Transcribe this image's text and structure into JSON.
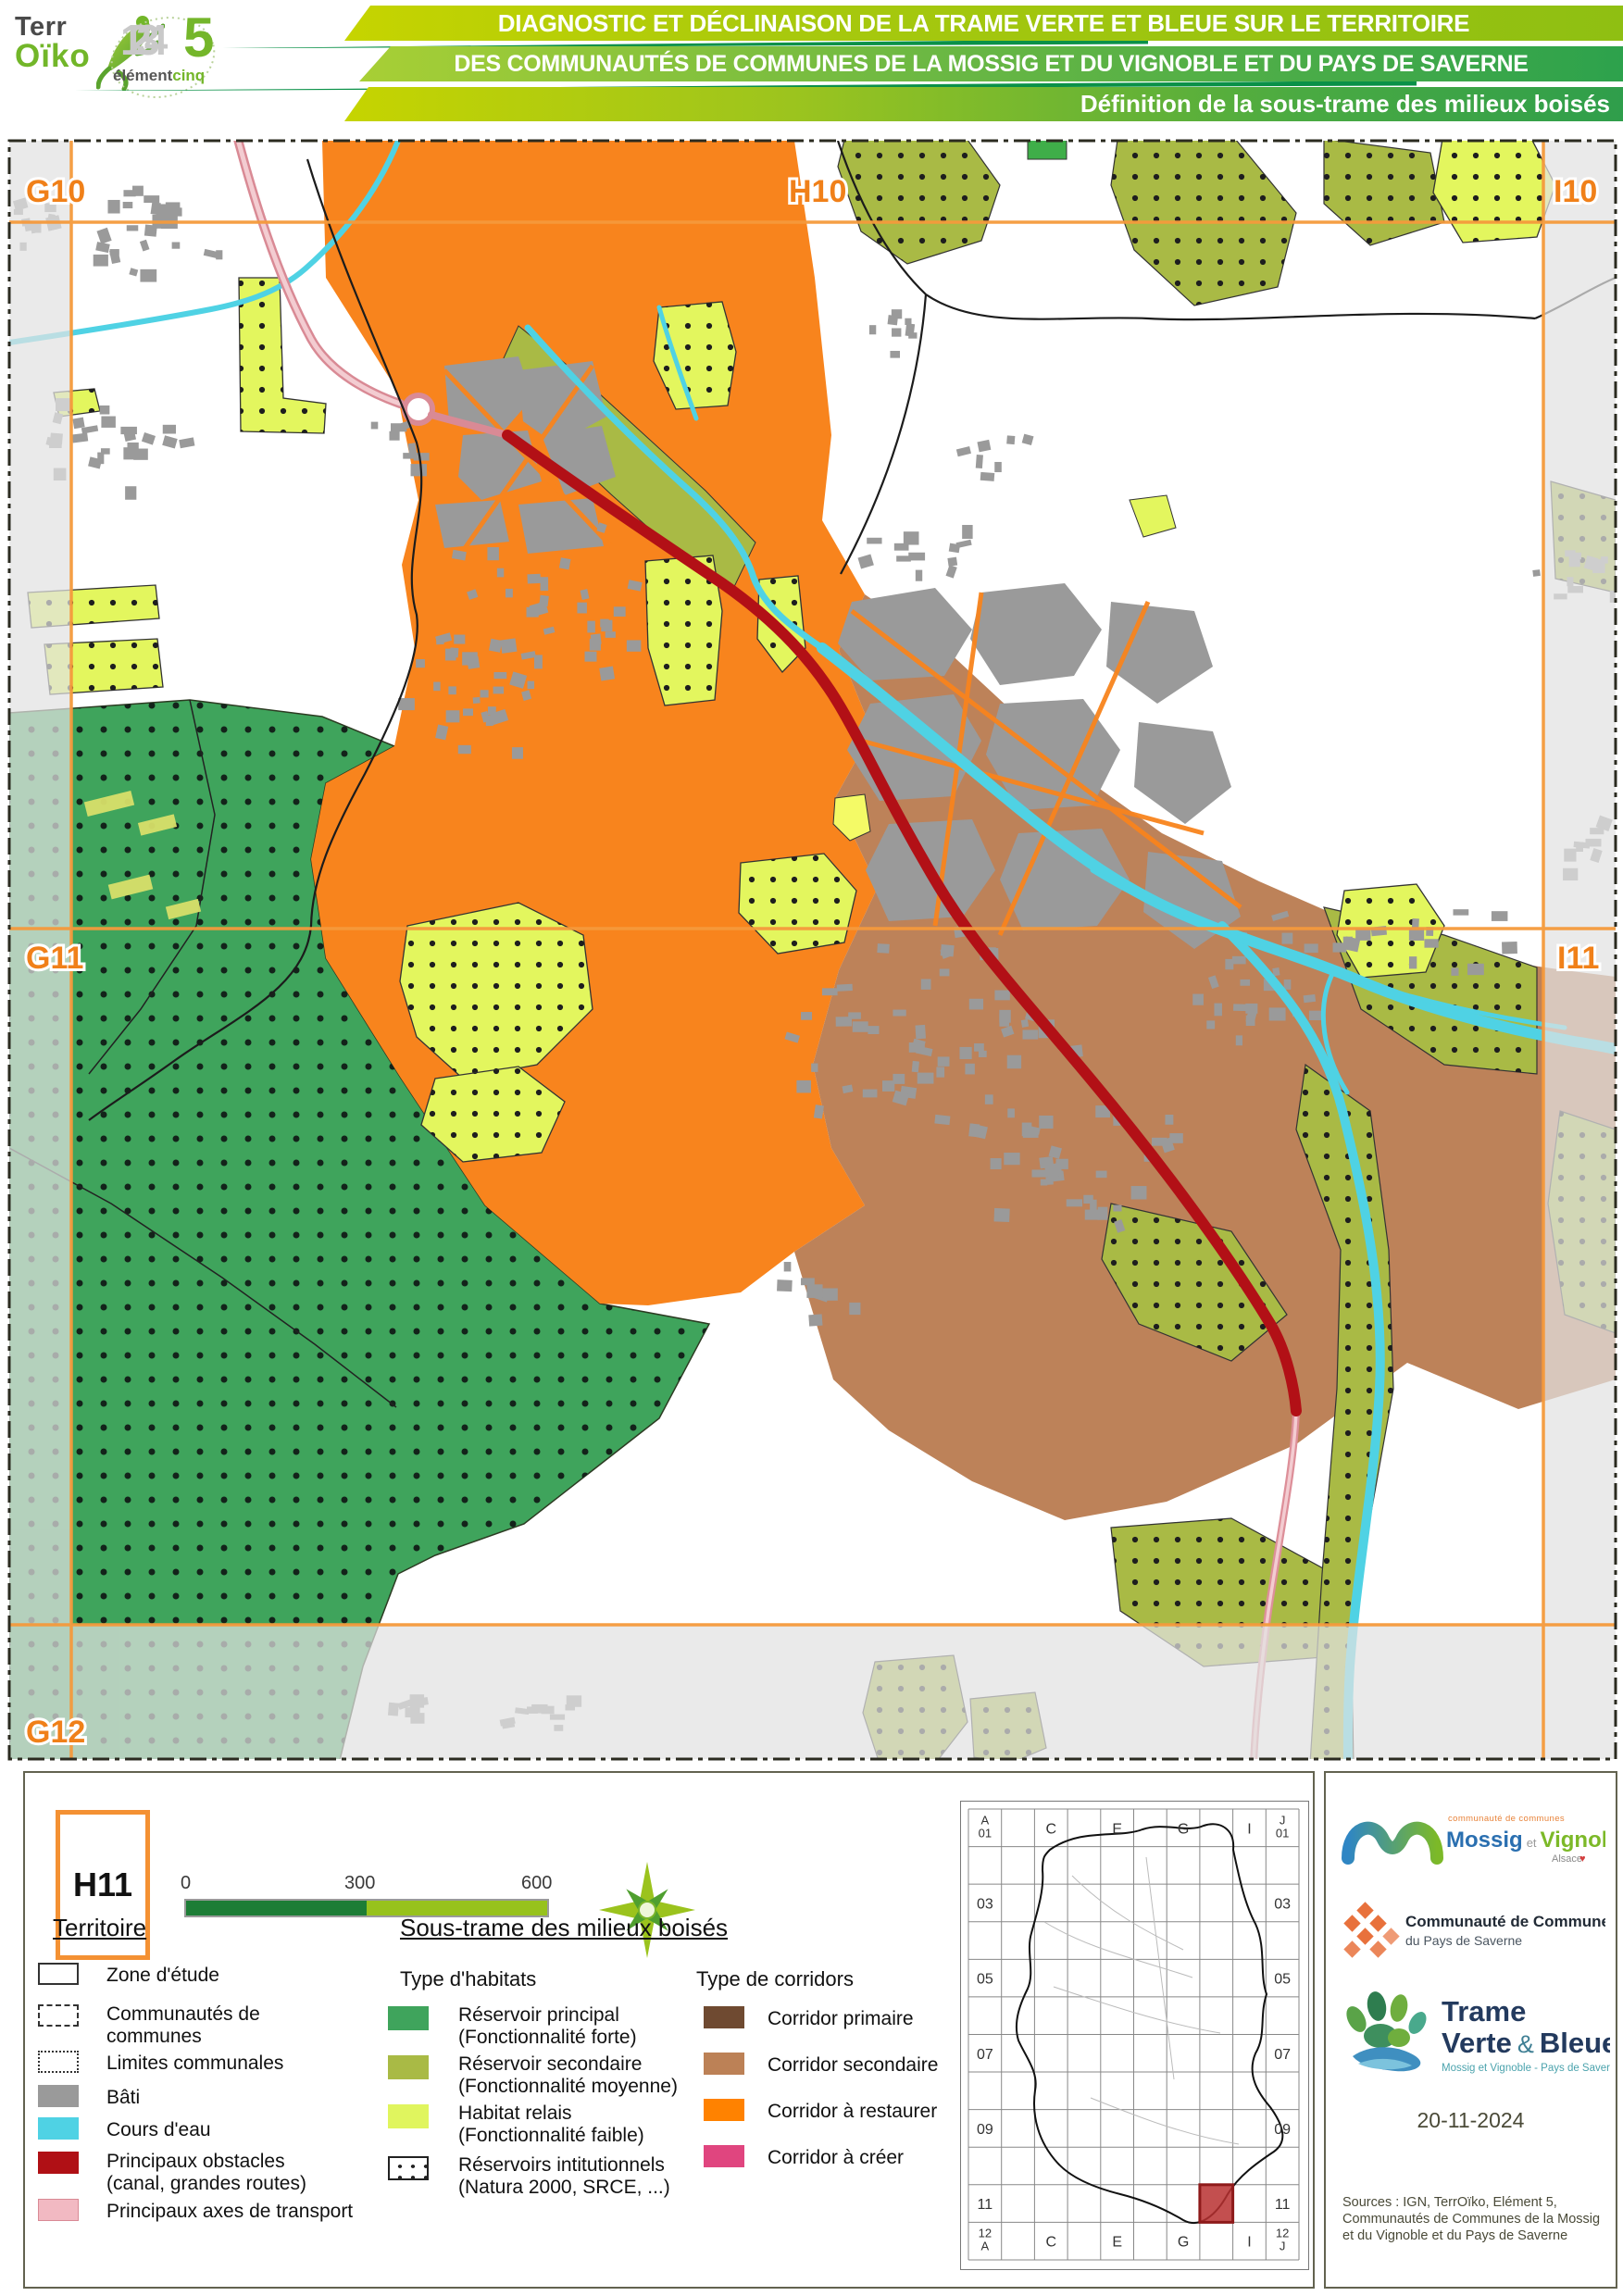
{
  "header": {
    "logo_terroiko": {
      "part1": "Terr",
      "part2": "Oïko"
    },
    "logo_element5": {
      "digits": "1234",
      "five": "5",
      "word1": "élément",
      "word2": "cinq"
    },
    "banner1": "DIAGNOSTIC ET DÉCLINAISON DE LA TRAME VERTE ET BLEUE SUR LE TERRITOIRE",
    "banner2": "DES COMMUNAUTÉS DE COMMUNES DE LA MOSSIG ET DU VIGNOBLE ET DU PAYS DE SAVERNE",
    "banner3": "Définition de la sous-trame des milieux boisés"
  },
  "map": {
    "grid_labels": [
      {
        "text": "G10"
      },
      {
        "text": "H10"
      },
      {
        "text": "I10"
      },
      {
        "text": "G11"
      },
      {
        "text": "I11"
      },
      {
        "text": "G12"
      }
    ]
  },
  "legend": {
    "tile": "H11",
    "scale": {
      "t0": "0",
      "t1": "300",
      "t2": "600 m"
    },
    "territoire": {
      "heading": "Territoire",
      "items": [
        {
          "label": "Zone d'étude"
        },
        {
          "label": "Communautés de communes"
        },
        {
          "label": "Limites communales"
        },
        {
          "label": "Bâti"
        },
        {
          "label": "Cours d'eau"
        },
        {
          "label": "Principaux obstacles (canal, grandes routes)"
        },
        {
          "label": "Principaux axes de transport"
        }
      ]
    },
    "soustrame": {
      "heading": "Sous-trame des milieux boisés",
      "habitats_title": "Type d'habitats",
      "habitats": [
        {
          "label": "Réservoir principal",
          "sub": "(Fonctionnalité forte)"
        },
        {
          "label": "Réservoir secondaire",
          "sub": "(Fonctionnalité moyenne)"
        },
        {
          "label": "Habitat relais",
          "sub": "(Fonctionnalité faible)"
        },
        {
          "label": "Réservoirs intitutionnels",
          "sub": "(Natura 2000, SRCE, ...)"
        }
      ],
      "corridors_title": "Type de corridors",
      "corridors": [
        {
          "label": "Corridor primaire"
        },
        {
          "label": "Corridor secondaire"
        },
        {
          "label": "Corridor à restaurer"
        },
        {
          "label": "Corridor à créer"
        }
      ]
    }
  },
  "minimap": {
    "labels": [
      {
        "c": 0,
        "r": 0,
        "t": "A|01"
      },
      {
        "c": 2,
        "r": 0,
        "t": "C"
      },
      {
        "c": 4,
        "r": 0,
        "t": "E"
      },
      {
        "c": 6,
        "r": 0,
        "t": "G"
      },
      {
        "c": 8,
        "r": 0,
        "t": "I"
      },
      {
        "c": 9,
        "r": 0,
        "t": "J|01"
      },
      {
        "c": 0,
        "r": 2,
        "t": "03"
      },
      {
        "c": 9,
        "r": 2,
        "t": "03"
      },
      {
        "c": 0,
        "r": 4,
        "t": "05"
      },
      {
        "c": 9,
        "r": 4,
        "t": "05"
      },
      {
        "c": 0,
        "r": 6,
        "t": "07"
      },
      {
        "c": 9,
        "r": 6,
        "t": "07"
      },
      {
        "c": 0,
        "r": 8,
        "t": "09"
      },
      {
        "c": 9,
        "r": 8,
        "t": "09"
      },
      {
        "c": 0,
        "r": 10,
        "t": "11"
      },
      {
        "c": 9,
        "r": 10,
        "t": "11"
      },
      {
        "c": 0,
        "r": 11,
        "t": "12|A"
      },
      {
        "c": 2,
        "r": 11,
        "t": "C"
      },
      {
        "c": 4,
        "r": 11,
        "t": "E"
      },
      {
        "c": 6,
        "r": 11,
        "t": "G"
      },
      {
        "c": 8,
        "r": 11,
        "t": "I"
      },
      {
        "c": 9,
        "r": 11,
        "t": "12|J"
      }
    ],
    "highlight_cell": "H11"
  },
  "credits": {
    "mossig": {
      "small": "communauté de communes",
      "name1": "Mossig",
      "et": "et",
      "name2": "Vignoble",
      "region": "Alsace"
    },
    "saverne": {
      "line1": "Communauté de Communes",
      "line2": "du Pays de Saverne"
    },
    "tvb": {
      "line1": "Trame",
      "line2a": "Verte",
      "amp": "&",
      "line2b": "Bleue",
      "sub": "Mossig et Vignoble - Pays de Saverne"
    },
    "date": "20-11-2024",
    "sources": "Sources : IGN, TerrOïko, Elément 5, Communautés de Communes de la Mossig et du Vignoble et du Pays de Saverne"
  },
  "colors": {
    "banner_yellow_green": "#C6D400",
    "banner_green": "#2DA24C",
    "grid_orange": "#F08019",
    "reservoir_principal": "#3FA45C",
    "reservoir_secondaire": "#A9BA45",
    "habitat_relais": "#E0F55E",
    "corridor_primaire": "#6F4A31",
    "corridor_secondaire": "#BC8156",
    "corridor_restaurer": "#FF8200",
    "corridor_creer": "#E0457F",
    "bati": "#9A9A9A",
    "cours_eau": "#4FD2E4",
    "obstacle": "#B01015",
    "axes_transport": "#F2B9C2"
  }
}
